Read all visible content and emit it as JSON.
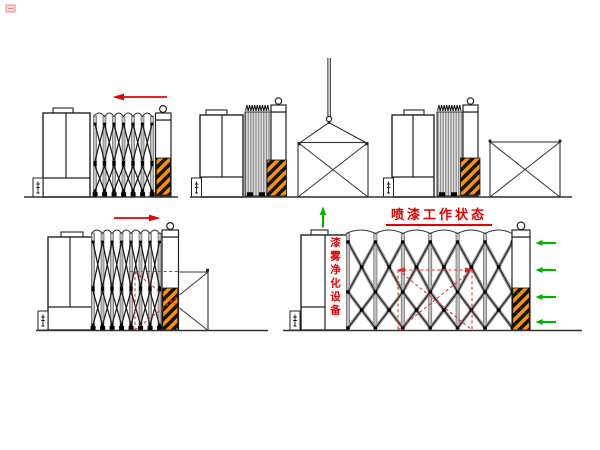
{
  "canvas": {
    "width": 600,
    "height": 450,
    "background": "#ffffff"
  },
  "labels": {
    "working_state_title": "喷漆工作状态",
    "equipment_vertical_label": "漆雾净化设备"
  },
  "colors": {
    "line_black": "#222222",
    "post_gray": "#c0c0c0",
    "hazard_orange": "#ff9100",
    "hazard_black": "#131313",
    "accent_red": "#e60000",
    "dashed_red": "#e62222",
    "arrow_green": "#00b400",
    "ground": "#333333"
  },
  "icons": {
    "retract_arrow": "red-arrow-left",
    "extend_arrow": "red-arrow-right",
    "vent_arrow": "green-arrow-up",
    "airflow_arrow": "green-arrow-left",
    "lift_gear": "crane-hook",
    "safety_marking": "orange-black-diagonal-stripes",
    "corner_mark": "watermark-stamp"
  },
  "counts": {
    "airflow_arrows": 4,
    "diagrams": 5
  }
}
